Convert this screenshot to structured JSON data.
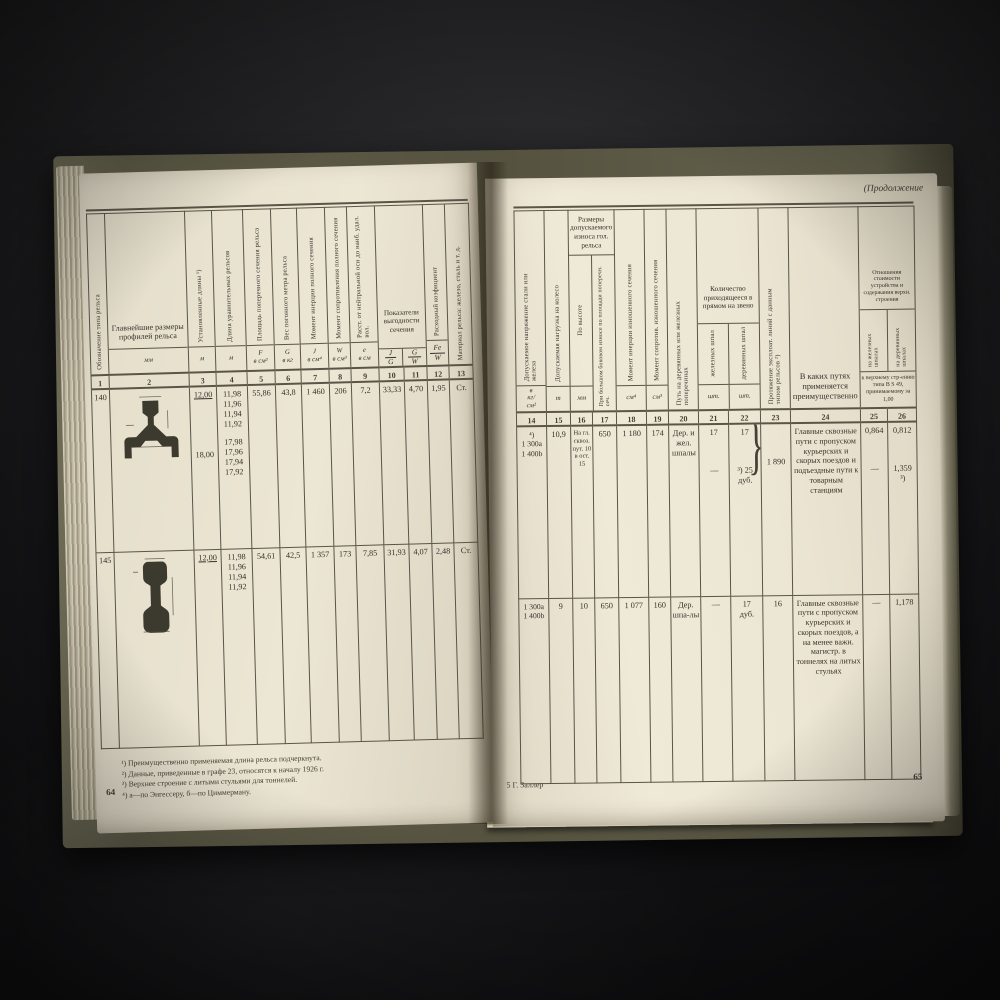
{
  "misc": {
    "brace": "}"
  },
  "left": {
    "cols": {
      "c1": "Обозначение типа рельса",
      "c2": "Главнейшие размеры профилей рельса",
      "c3": "Установленные длины ¹)",
      "c4": "Длина уравнительных рельсов",
      "c5": "Площадь поперечного сечения рельса",
      "c6": "Вес погонного метра рельса",
      "c7": "Момент инерции полного сечения",
      "c8": "Момент сопротивления полного сечения",
      "c9": "Расст. от нейтральной оси до наиб. удал. вол.",
      "c10_11": "Показатели выгодности сечения",
      "c12": "Расходный коэфициент",
      "c13": "Материал рельса: железо, сталь и т. д."
    },
    "units": {
      "c2": "мм",
      "c3": "м",
      "c4": "м",
      "c5": "F\nв см²",
      "c6": "G\nв кг",
      "c7": "J\nв см⁴",
      "c8": "W\nв см³",
      "c9": "е\nв см",
      "jg": {
        "num": "J",
        "den": "G"
      },
      "gw": {
        "num": "G",
        "den": "W"
      },
      "few": {
        "num": "Fe",
        "den": "W"
      }
    },
    "numbers": [
      "1",
      "2",
      "3",
      "4",
      "5",
      "6",
      "7",
      "8",
      "9",
      "10",
      "11",
      "12",
      "13"
    ],
    "rows": [
      {
        "type": "140",
        "len_a": "12,00",
        "len_b": "18,00",
        "eq_a": "11,98\n11,96\n11,94\n11,92",
        "eq_b": "17,98\n17,96\n17,94\n17,92",
        "f": "55,86",
        "g": "43,8",
        "j": "1 460",
        "w": "206",
        "e": "7,2",
        "jg": "33,33",
        "gw": "4,70",
        "few": "1,95",
        "mat": "Ст."
      },
      {
        "type": "145",
        "len_a": "12,00",
        "len_b": "",
        "eq_a": "11,98\n11,96\n11,94\n11,92",
        "eq_b": "",
        "f": "54,61",
        "g": "42,5",
        "j": "1 357",
        "w": "173",
        "e": "7,85",
        "jg": "31,93",
        "gw": "4,07",
        "few": "2,48",
        "mat": "Ст."
      }
    ],
    "footnotes": [
      "¹) Преимущественно применяемая длина рельса подчеркнута.",
      "²) Данные, приведенные в графе 23, относятся к началу 1926 г.",
      "³) Верхнее строение с литыми стульями для тоннелей.",
      "⁴) а—по Энгессеру, б—по Циммерману."
    ],
    "page_number": "64"
  },
  "right": {
    "continuation": "(Продолжение",
    "cols": {
      "c14": "Допускаемое напряжение стали или железа",
      "c15": "Допускаемая нагрузка на колесо",
      "c16_17": "Размеры допускаемого износа гол. рельса",
      "c16": "По высоте",
      "c17": "При большом боковом износе по площади поперечн. сеч.",
      "c18": "Момент инерции изношенного сечения",
      "c19": "Момент сопротив. изношенного сечения",
      "c20": "Путь на деревянных или железных поперечинах",
      "c21_22": "Количество приходящееся в прямом на звено",
      "c21": "железных шпал",
      "c22": "деревянных шпал",
      "c23": "Протяжение эксплоат. линий с данным типом рельсов ²)",
      "c24": "В каких путях применяется преимущественно",
      "c25_26": "Отношения стоимости устройства и содержания верхн. строения",
      "c25": "на железных шпалах",
      "c26": "на деревянных шпалах",
      "c25_26_note": "к верхнему стр-ению типа В S 49, принимаемому за 1,00"
    },
    "units": {
      "c14": "в\nкг/\nсм²",
      "c15": "т",
      "c16": "мм",
      "c18": "см⁴",
      "c19": "см³",
      "c21": "шт.",
      "c22": "шт."
    },
    "numbers": [
      "14",
      "15",
      "16",
      "17",
      "18",
      "19",
      "20",
      "21",
      "22",
      "23",
      "24",
      "25",
      "26"
    ],
    "rows": [
      {
        "c14": "⁴)\n1 300a\n1 400b",
        "c15": "10,9",
        "c16": "На гл. сквоз. пут. 10 в ост. 15",
        "c17": "650",
        "c18": "1 180",
        "c19": "174",
        "c20": "Дер. и жел. шпалы",
        "c21a": "17",
        "c21b": "—",
        "c22a": "17",
        "c22b": "³) 25\nдуб.",
        "c23": "1 890",
        "c24": "Главные сквозные пути с пропуском курьерских и скорых поездов и подъездные пути к товарным станциям",
        "c25a": "0,864",
        "c25b": "—",
        "c26a": "0,812",
        "c26b": "1,359\n³)"
      },
      {
        "c14": "1 300a\n1 400b",
        "c15": "9",
        "c16": "10",
        "c17": "650",
        "c18": "1 077",
        "c19": "160",
        "c20": "Дер. шпа-лы",
        "c21a": "—",
        "c21b": "",
        "c22a": "17\nдуб.",
        "c22b": "",
        "c23": "16",
        "c24": "Главные сквозные пути с пропуском курьерских и скорых поездов, а на менее важн. магистр. в тоннелях на литых стульях",
        "c25a": "—",
        "c25b": "",
        "c26a": "1,178",
        "c26b": ""
      }
    ],
    "footer_sig": "5  Г. Заллер",
    "page_number": "65"
  }
}
